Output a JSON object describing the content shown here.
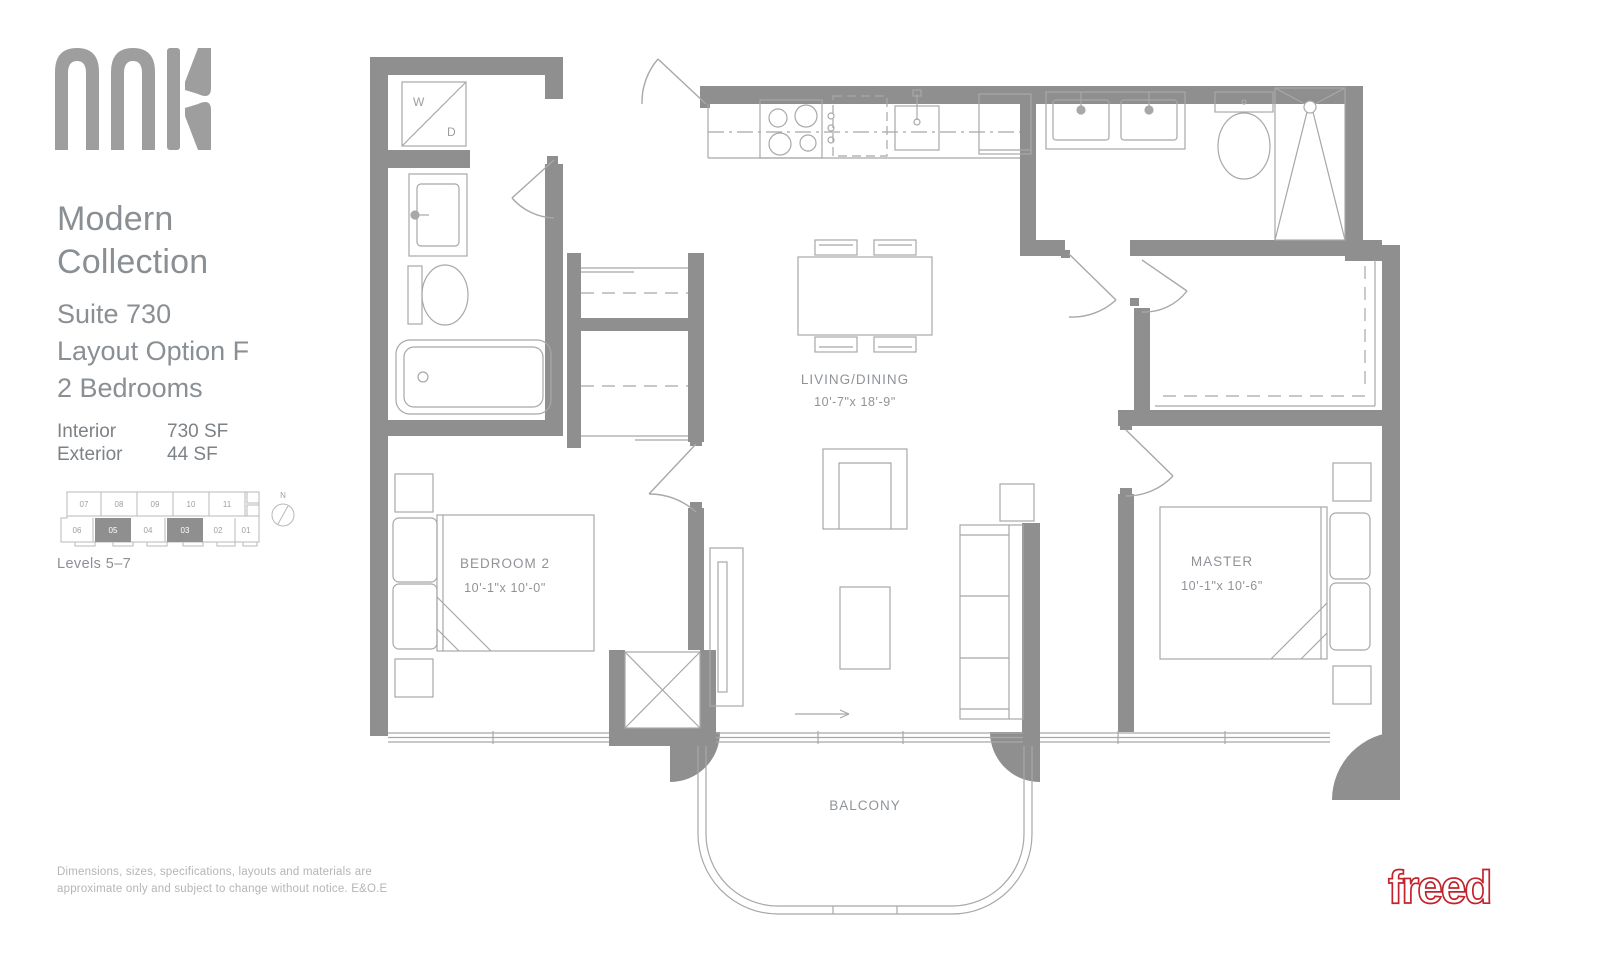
{
  "branding": {
    "logo_text": "anx",
    "developer": "freed"
  },
  "sidebar": {
    "collection_line1": "Modern",
    "collection_line2": "Collection",
    "suite": "Suite 730",
    "layout": "Layout Option F",
    "bedrooms": "2 Bedrooms",
    "areas": [
      {
        "label": "Interior",
        "value": "730 SF"
      },
      {
        "label": "Exterior",
        "value": "44 SF"
      }
    ],
    "keyplan": {
      "top_units": [
        "07",
        "08",
        "09",
        "10",
        "11"
      ],
      "bottom_units": [
        "06",
        "05",
        "04",
        "03",
        "02",
        "01"
      ],
      "highlighted_units": [
        "05",
        "03"
      ],
      "compass_label": "N",
      "levels": "Levels 5–7"
    },
    "disclaimer_line1": "Dimensions, sizes, specifications, layouts and materials are",
    "disclaimer_line2": "approximate only and subject to change without notice. E&O.E"
  },
  "floorplan": {
    "living_dining": {
      "name": "LIVING/DINING",
      "dims": "10'-7\"x 18'-9\""
    },
    "bedroom2": {
      "name": "BEDROOM 2",
      "dims": "10'-1\"x 10'-0\""
    },
    "master": {
      "name": "MASTER",
      "dims": "10'-1\"x 10'-6\""
    },
    "balcony": {
      "name": "BALCONY"
    },
    "washer": "W",
    "dryer": "D"
  },
  "colors": {
    "wall": "#8f8f8f",
    "fixture_line": "#a8a8a8",
    "plan_text": "#8f9398",
    "brand_red": "#c2242e",
    "logo_gray": "#9e9e9e"
  }
}
